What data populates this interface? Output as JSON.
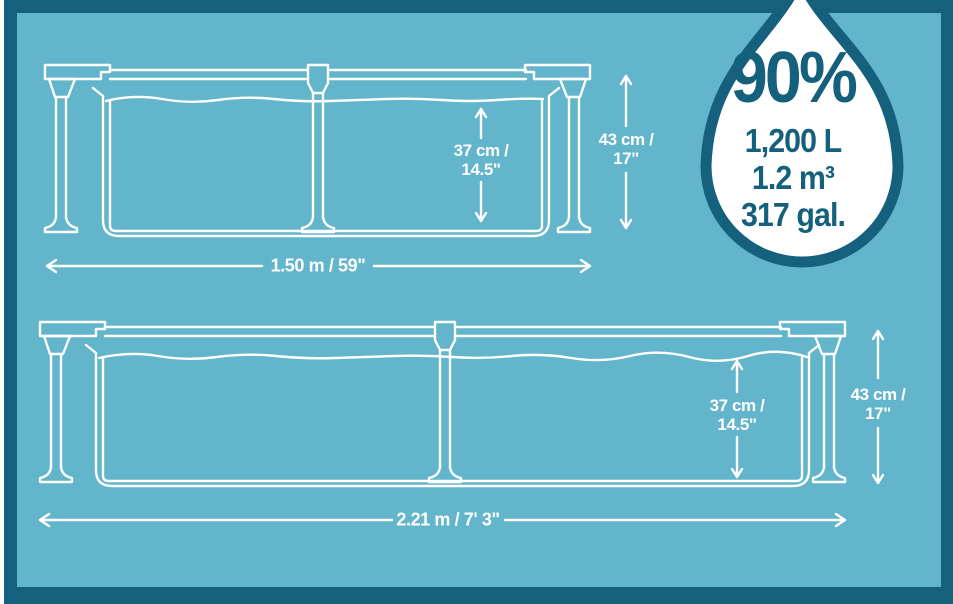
{
  "badge": {
    "percent": "90%",
    "volume_liters": "1,200 L",
    "volume_cubic_meters": "1.2 m³",
    "volume_gallons": "317 gal."
  },
  "pool_small": {
    "length_label": "1.50 m / 59\"",
    "water_depth_line1": "37 cm /",
    "water_depth_line2": "14.5\"",
    "frame_height_line1": "43 cm /",
    "frame_height_line2": "17\""
  },
  "pool_large": {
    "length_label": "2.21 m / 7' 3\"",
    "water_depth_line1": "37 cm /",
    "water_depth_line2": "14.5\"",
    "frame_height_line1": "43 cm /",
    "frame_height_line2": "17\""
  },
  "colors": {
    "background_teal": "#62b5cb",
    "frame_dark_teal": "#15607c",
    "line_art_white": "#ffffff"
  }
}
